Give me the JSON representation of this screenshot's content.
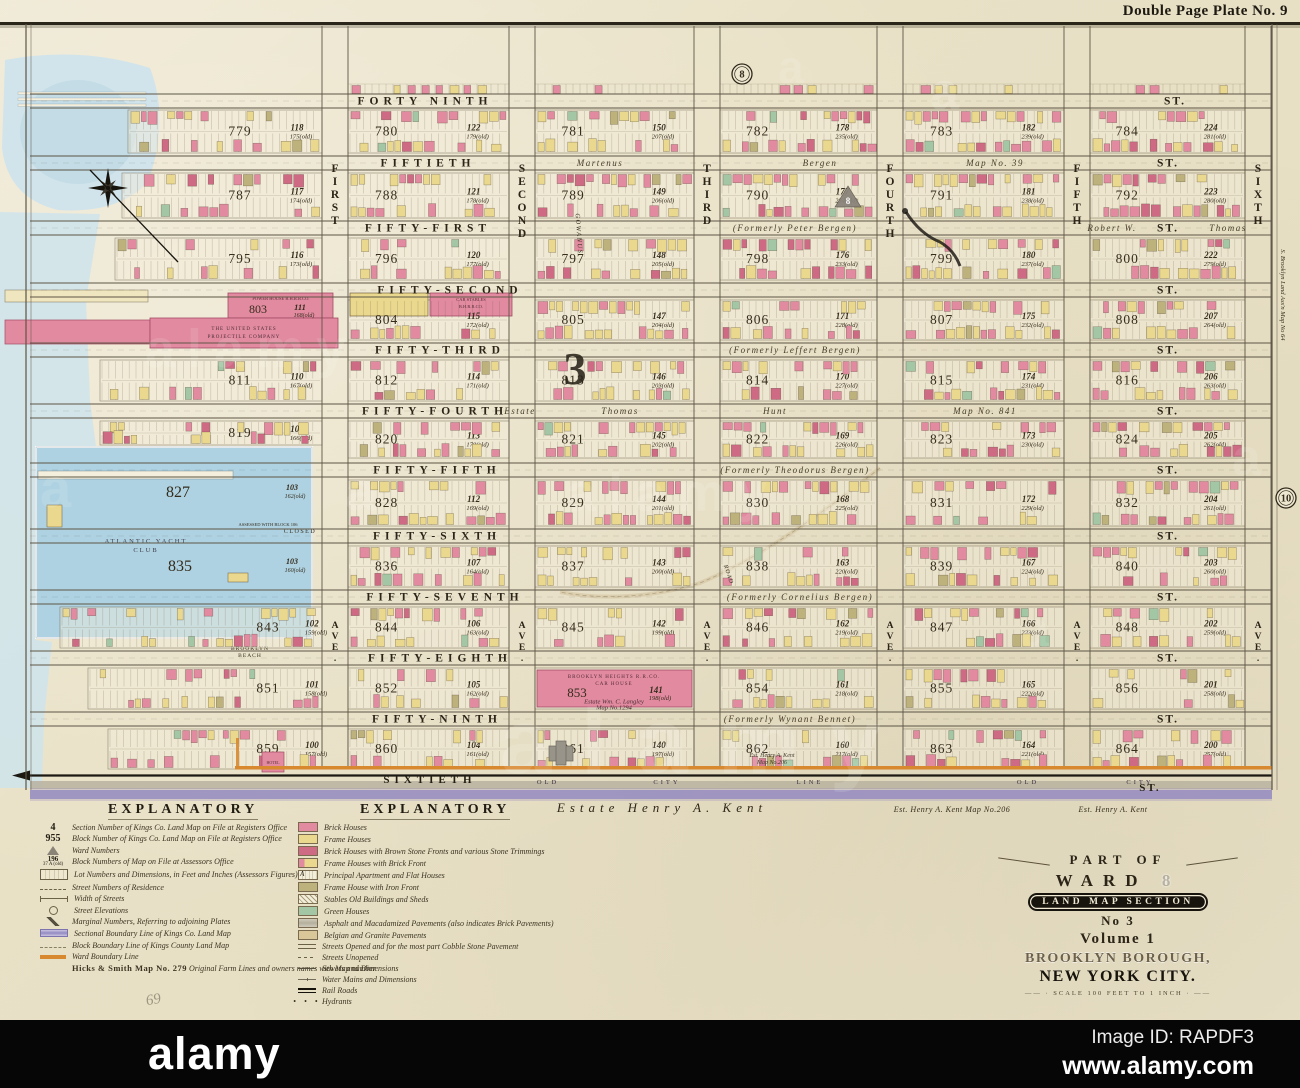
{
  "plate": {
    "title": "Double Page Plate No. 9"
  },
  "marginals": {
    "top_plate": "8",
    "right_plate": "10",
    "section_number": "3",
    "ward_number": "8"
  },
  "map": {
    "streets": [
      {
        "name": "FORTY NINTH",
        "suffix": "ST.",
        "y": 101,
        "nx": 425,
        "sx": 1175,
        "annos": []
      },
      {
        "name": "FIFTIETH",
        "suffix": "ST.",
        "y": 163,
        "nx": 428,
        "sx": 1168,
        "annos": [
          {
            "t": "Martenus",
            "x": 600
          },
          {
            "t": "Bergen",
            "x": 820
          },
          {
            "t": "Map No. 39",
            "x": 995
          }
        ]
      },
      {
        "name": "FIFTY-FIRST",
        "suffix": "ST.",
        "y": 228,
        "nx": 428,
        "sx": 1168,
        "annos": [
          {
            "t": "(Formerly  Peter  Bergen)",
            "x": 795
          },
          {
            "t": "Robert W.",
            "x": 1112
          },
          {
            "t": "Thomas",
            "x": 1228
          }
        ]
      },
      {
        "name": "FIFTY-SECOND",
        "suffix": "ST.",
        "y": 290,
        "nx": 450,
        "sx": 1168,
        "annos": []
      },
      {
        "name": "FIFTY-THIRD",
        "suffix": "ST.",
        "y": 350,
        "nx": 440,
        "sx": 1168,
        "annos": [
          {
            "t": "(Formerly  Leffert  Bergen)",
            "x": 795
          }
        ]
      },
      {
        "name": "FIFTY-FOURTH",
        "suffix": "ST.",
        "y": 411,
        "nx": 435,
        "sx": 1168,
        "annos": [
          {
            "t": "Estate",
            "x": 520
          },
          {
            "t": "Thomas",
            "x": 620
          },
          {
            "t": "Hunt",
            "x": 775
          },
          {
            "t": "Map No. 841",
            "x": 985
          }
        ]
      },
      {
        "name": "FIFTY-FIFTH",
        "suffix": "ST.",
        "y": 470,
        "nx": 437,
        "sx": 1168,
        "annos": [
          {
            "t": "(Formerly  Theodorus  Bergen)",
            "x": 795
          }
        ]
      },
      {
        "name": "FIFTY-SIXTH",
        "suffix": "ST.",
        "y": 536,
        "nx": 437,
        "sx": 1168,
        "annos": []
      },
      {
        "name": "FIFTY-SEVENTH",
        "suffix": "ST.",
        "y": 597,
        "nx": 445,
        "sx": 1168,
        "annos": [
          {
            "t": "(Formerly  Cornelius  Bergen)",
            "x": 800
          }
        ]
      },
      {
        "name": "FIFTY-EIGHTH",
        "suffix": "ST.",
        "y": 658,
        "nx": 440,
        "sx": 1168,
        "annos": []
      },
      {
        "name": "FIFTY-NINTH",
        "suffix": "ST.",
        "y": 719,
        "nx": 437,
        "sx": 1168,
        "annos": [
          {
            "t": "(Formerly  Wynant  Bennet)",
            "x": 790
          }
        ]
      },
      {
        "name": "SIXTIETH",
        "suffix": "ST.",
        "y": 779,
        "nx": 430,
        "sx": 1150,
        "annos": [
          {
            "t": "OLD",
            "x": 548
          },
          {
            "t": "CITY",
            "x": 667
          },
          {
            "t": "LINE",
            "x": 810
          },
          {
            "t": "OLD",
            "x": 1028
          },
          {
            "t": "CITY",
            "x": 1140
          }
        ]
      }
    ],
    "avenues": [
      {
        "name": "FIRST",
        "x": 335
      },
      {
        "name": "SECOND",
        "x": 522
      },
      {
        "name": "THIRD",
        "x": 707
      },
      {
        "name": "FOURTH",
        "x": 890
      },
      {
        "name": "FIFTH",
        "x": 1077
      },
      {
        "name": "SIXTH",
        "x": 1258
      }
    ],
    "ave_suffix": "AVE.",
    "blocks": [
      {
        "n": "779",
        "l": "118",
        "o": "175",
        "c": 0,
        "r": 0
      },
      {
        "n": "780",
        "l": "122",
        "o": "179",
        "c": 1,
        "r": 0
      },
      {
        "n": "781",
        "l": "150",
        "o": "207",
        "c": 2,
        "r": 0
      },
      {
        "n": "782",
        "l": "178",
        "o": "235",
        "c": 3,
        "r": 0
      },
      {
        "n": "783",
        "l": "182",
        "o": "239",
        "c": 4,
        "r": 0
      },
      {
        "n": "784",
        "l": "224",
        "o": "281",
        "c": 5,
        "r": 0
      },
      {
        "n": "787",
        "l": "117",
        "o": "174",
        "c": 0,
        "r": 1
      },
      {
        "n": "788",
        "l": "121",
        "o": "178",
        "c": 1,
        "r": 1
      },
      {
        "n": "789",
        "l": "149",
        "o": "206",
        "c": 2,
        "r": 1
      },
      {
        "n": "790",
        "l": "177",
        "o": "234",
        "c": 3,
        "r": 1
      },
      {
        "n": "791",
        "l": "181",
        "o": "238",
        "c": 4,
        "r": 1
      },
      {
        "n": "792",
        "l": "223",
        "o": "280",
        "c": 5,
        "r": 1
      },
      {
        "n": "795",
        "l": "116",
        "o": "173",
        "c": 0,
        "r": 2
      },
      {
        "n": "796",
        "l": "120",
        "o": "177",
        "c": 1,
        "r": 2
      },
      {
        "n": "797",
        "l": "148",
        "o": "205",
        "c": 2,
        "r": 2
      },
      {
        "n": "798",
        "l": "176",
        "o": "233",
        "c": 3,
        "r": 2
      },
      {
        "n": "799",
        "l": "180",
        "o": "237",
        "c": 4,
        "r": 2
      },
      {
        "n": "800",
        "l": "222",
        "o": "279",
        "c": 5,
        "r": 2
      },
      {
        "n": "803",
        "l": "111",
        "o": "168",
        "c": 0,
        "r": 3,
        "sp": "power"
      },
      {
        "n": "804",
        "l": "115",
        "o": "172",
        "c": 1,
        "r": 3,
        "sp": "stables"
      },
      {
        "n": "805",
        "l": "147",
        "o": "204",
        "c": 2,
        "r": 3
      },
      {
        "n": "806",
        "l": "171",
        "o": "228",
        "c": 3,
        "r": 3
      },
      {
        "n": "807",
        "l": "175",
        "o": "232",
        "c": 4,
        "r": 3
      },
      {
        "n": "808",
        "l": "207",
        "o": "264",
        "c": 5,
        "r": 3
      },
      {
        "n": "811",
        "l": "110",
        "o": "167",
        "c": 0,
        "r": 4
      },
      {
        "n": "812",
        "l": "114",
        "o": "171",
        "c": 1,
        "r": 4
      },
      {
        "n": "813",
        "l": "146",
        "o": "203",
        "c": 2,
        "r": 4
      },
      {
        "n": "814",
        "l": "170",
        "o": "227",
        "c": 3,
        "r": 4
      },
      {
        "n": "815",
        "l": "174",
        "o": "231",
        "c": 4,
        "r": 4
      },
      {
        "n": "816",
        "l": "206",
        "o": "263",
        "c": 5,
        "r": 4
      },
      {
        "n": "819",
        "l": "109",
        "o": "166",
        "c": 0,
        "r": 5
      },
      {
        "n": "820",
        "l": "113",
        "o": "170",
        "c": 1,
        "r": 5
      },
      {
        "n": "821",
        "l": "145",
        "o": "202",
        "c": 2,
        "r": 5
      },
      {
        "n": "822",
        "l": "169",
        "o": "226",
        "c": 3,
        "r": 5
      },
      {
        "n": "823",
        "l": "173",
        "o": "230",
        "c": 4,
        "r": 5
      },
      {
        "n": "824",
        "l": "205",
        "o": "262",
        "c": 5,
        "r": 5
      },
      {
        "n": "828",
        "l": "112",
        "o": "169",
        "c": 1,
        "r": 6
      },
      {
        "n": "829",
        "l": "144",
        "o": "201",
        "c": 2,
        "r": 6
      },
      {
        "n": "830",
        "l": "168",
        "o": "225",
        "c": 3,
        "r": 6
      },
      {
        "n": "831",
        "l": "172",
        "o": "229",
        "c": 4,
        "r": 6
      },
      {
        "n": "832",
        "l": "204",
        "o": "261",
        "c": 5,
        "r": 6
      },
      {
        "n": "836",
        "l": "107",
        "o": "164",
        "c": 1,
        "r": 7
      },
      {
        "n": "837",
        "l": "143",
        "o": "200",
        "c": 2,
        "r": 7
      },
      {
        "n": "838",
        "l": "163",
        "o": "220",
        "c": 3,
        "r": 7
      },
      {
        "n": "839",
        "l": "167",
        "o": "224",
        "c": 4,
        "r": 7
      },
      {
        "n": "840",
        "l": "203",
        "o": "260",
        "c": 5,
        "r": 7
      },
      {
        "n": "843",
        "l": "102",
        "o": "159",
        "c": 0,
        "r": 8
      },
      {
        "n": "844",
        "l": "106",
        "o": "163",
        "c": 1,
        "r": 8
      },
      {
        "n": "845",
        "l": "142",
        "o": "199",
        "c": 2,
        "r": 8
      },
      {
        "n": "846",
        "l": "162",
        "o": "219",
        "c": 3,
        "r": 8
      },
      {
        "n": "847",
        "l": "166",
        "o": "223",
        "c": 4,
        "r": 8
      },
      {
        "n": "848",
        "l": "202",
        "o": "259",
        "c": 5,
        "r": 8
      },
      {
        "n": "851",
        "l": "101",
        "o": "158",
        "c": 0,
        "r": 9
      },
      {
        "n": "852",
        "l": "105",
        "o": "162",
        "c": 1,
        "r": 9
      },
      {
        "n": "853",
        "l": "141",
        "o": "198",
        "c": 2,
        "r": 9,
        "sp": "carhouse"
      },
      {
        "n": "854",
        "l": "161",
        "o": "218",
        "c": 3,
        "r": 9
      },
      {
        "n": "855",
        "l": "165",
        "o": "222",
        "c": 4,
        "r": 9
      },
      {
        "n": "856",
        "l": "201",
        "o": "258",
        "c": 5,
        "r": 9
      },
      {
        "n": "859",
        "l": "100",
        "o": "157",
        "c": 0,
        "r": 10
      },
      {
        "n": "860",
        "l": "104",
        "o": "161",
        "c": 1,
        "r": 10
      },
      {
        "n": "861",
        "l": "140",
        "o": "197",
        "c": 2,
        "r": 10
      },
      {
        "n": "862",
        "l": "160",
        "o": "217",
        "c": 3,
        "r": 10
      },
      {
        "n": "863",
        "l": "164",
        "o": "221",
        "c": 4,
        "r": 10
      },
      {
        "n": "864",
        "l": "200",
        "o": "257",
        "c": 5,
        "r": 10
      }
    ],
    "water": {
      "club_line1": "ATLANTIC  YACHT",
      "club_line2": "CLUB",
      "basin_block_upper": "827",
      "basin_block_lower": "835",
      "shore_lot_upper": "103",
      "shore_old_upper": "162(old)",
      "shore_lot_lower": "103",
      "shore_old_lower": "160(old)",
      "beach_line1": "BROOKLYN",
      "beach_line2": "BEACH",
      "closed_note1": "ASSESSED WITH BLOCK 106",
      "closed_note2": "CLOSED"
    },
    "special": {
      "power_house": "POWER HOUSE  B.H.R.R.CO.",
      "projectile1": "THE  UNITED  STATES",
      "projectile2": "PROJECTILE  COMPANY",
      "car_stables1": "CAR  STABLES",
      "car_stables2": "B.H.R.R.CO.",
      "car_house1": "BROOKLYN  HEIGHTS  R.R.CO.",
      "car_house2": "CAR  HOUSE",
      "car_house3": "Estate  Wm. C. Langley",
      "car_house4": "Map No.1294",
      "hotel": "HOTEL",
      "gowanus": "GOWANUS",
      "road": "ROAD",
      "kent_big": "Estate    Henry    A.    Kent",
      "kent_206": "Est. Henry A. Kent   Map No.206",
      "kent_plain": "Est. Henry A. Kent",
      "kent_block1": "Est. Henry A. Kent",
      "kent_block2": "Map No.206",
      "margin_note": "S. Brooklyn Land Ass'n Map No 64"
    }
  },
  "legend_left": {
    "title": "EXPLANATORY",
    "items": [
      {
        "sym": "num",
        "sym_text": "4",
        "text": "Section Number of Kings Co. Land Map on File at Registers Office"
      },
      {
        "sym": "num",
        "sym_text": "955",
        "text": "Block Number of Kings Co. Land Map on File at Registers Office"
      },
      {
        "sym": "tri",
        "text": "Ward Numbers"
      },
      {
        "sym": "num2",
        "sym_text": "196",
        "sym_text2": "37 A (old)",
        "text": "Block Numbers of Map on File at Assessors Office"
      },
      {
        "sym": "lots",
        "text": "Lot Numbers and Dimensions, in Feet and Inches (Assessors Figures)"
      },
      {
        "sym": "resid",
        "text": "Street Numbers of Residence"
      },
      {
        "sym": "width",
        "text": "Width of Streets"
      },
      {
        "sym": "elev",
        "text": "Street Elevations"
      },
      {
        "sym": "marg",
        "text": "Marginal Numbers, Referring to adjoining Plates"
      },
      {
        "sym": "sect",
        "text": "Sectional Boundary Line of Kings Co. Land Map"
      },
      {
        "sym": "blockb",
        "text": "Block Boundary Line of Kings County Land Map"
      },
      {
        "sym": "ward",
        "text": "Ward Boundary Line"
      },
      {
        "sym": "none",
        "prefix": "Hicks & Smith Map No. 279",
        "text": "  Original Farm Lines and owners names with Map number"
      }
    ]
  },
  "legend_right": {
    "title": "EXPLANATORY",
    "items": [
      {
        "sym": "sw-brick",
        "text": "Brick Houses"
      },
      {
        "sym": "sw-frame",
        "text": "Frame Houses"
      },
      {
        "sym": "sw-brown",
        "text": "Brick Houses with Brown Stone Fronts and various Stone Trimmings"
      },
      {
        "sym": "sw-fbrick",
        "text": "Frame Houses with Brick Front"
      },
      {
        "sym": "sw-apart",
        "text": "Principal Apartment and Flat Houses"
      },
      {
        "sym": "sw-iron",
        "text": "Frame House with Iron Front"
      },
      {
        "sym": "sw-stable",
        "text": "Stables Old Buildings and Sheds"
      },
      {
        "sym": "sw-green",
        "text": "Green Houses"
      },
      {
        "sym": "sw-asph",
        "text": "Asphalt and Macadamized Pavements (also indicates Brick Pavements)"
      },
      {
        "sym": "sw-belg",
        "text": "Belgian and Granite Pavements"
      },
      {
        "sym": "sw-open",
        "text": "Streets Opened and for the most part Cobble Stone Pavement"
      },
      {
        "sym": "sw-unop",
        "text": "Streets Unopened"
      },
      {
        "sym": "sw-sewer",
        "text": "Sewers and Dimensions"
      },
      {
        "sym": "sw-water",
        "text": "Water Mains and Dimensions"
      },
      {
        "sym": "sw-rail",
        "text": "Rail Roads"
      },
      {
        "sym": "sw-hydr",
        "text": "Hydrants"
      }
    ]
  },
  "cartouche": {
    "part_of": "PART OF",
    "ward_label": "WARD",
    "ward_number": "8",
    "banner": "LAND MAP SECTION",
    "no": "No 3",
    "volume": "Volume 1",
    "borough": "BROOKLYN BOROUGH,",
    "city": "NEW YORK CITY.",
    "scale": "SCALE  100 FEET TO 1 INCH"
  },
  "pencil": {
    "note": "69"
  },
  "watermark": {
    "brand": "alamy",
    "image_id": "Image ID: RAPDF3",
    "url": "www.alamy.com"
  },
  "palette": {
    "brick": "#e28aa0",
    "brown": "#cf6a85",
    "frame": "#e9d88d",
    "iron": "#bdb27b",
    "green": "#a3c7a5",
    "gray_bldg": "#98948a",
    "water": "#cfe4ec",
    "basin": "#aed2e2",
    "ward_line": "#d8882e",
    "sectional": "#938ac1",
    "rail": "#1c1913",
    "line": "#5d5545"
  }
}
